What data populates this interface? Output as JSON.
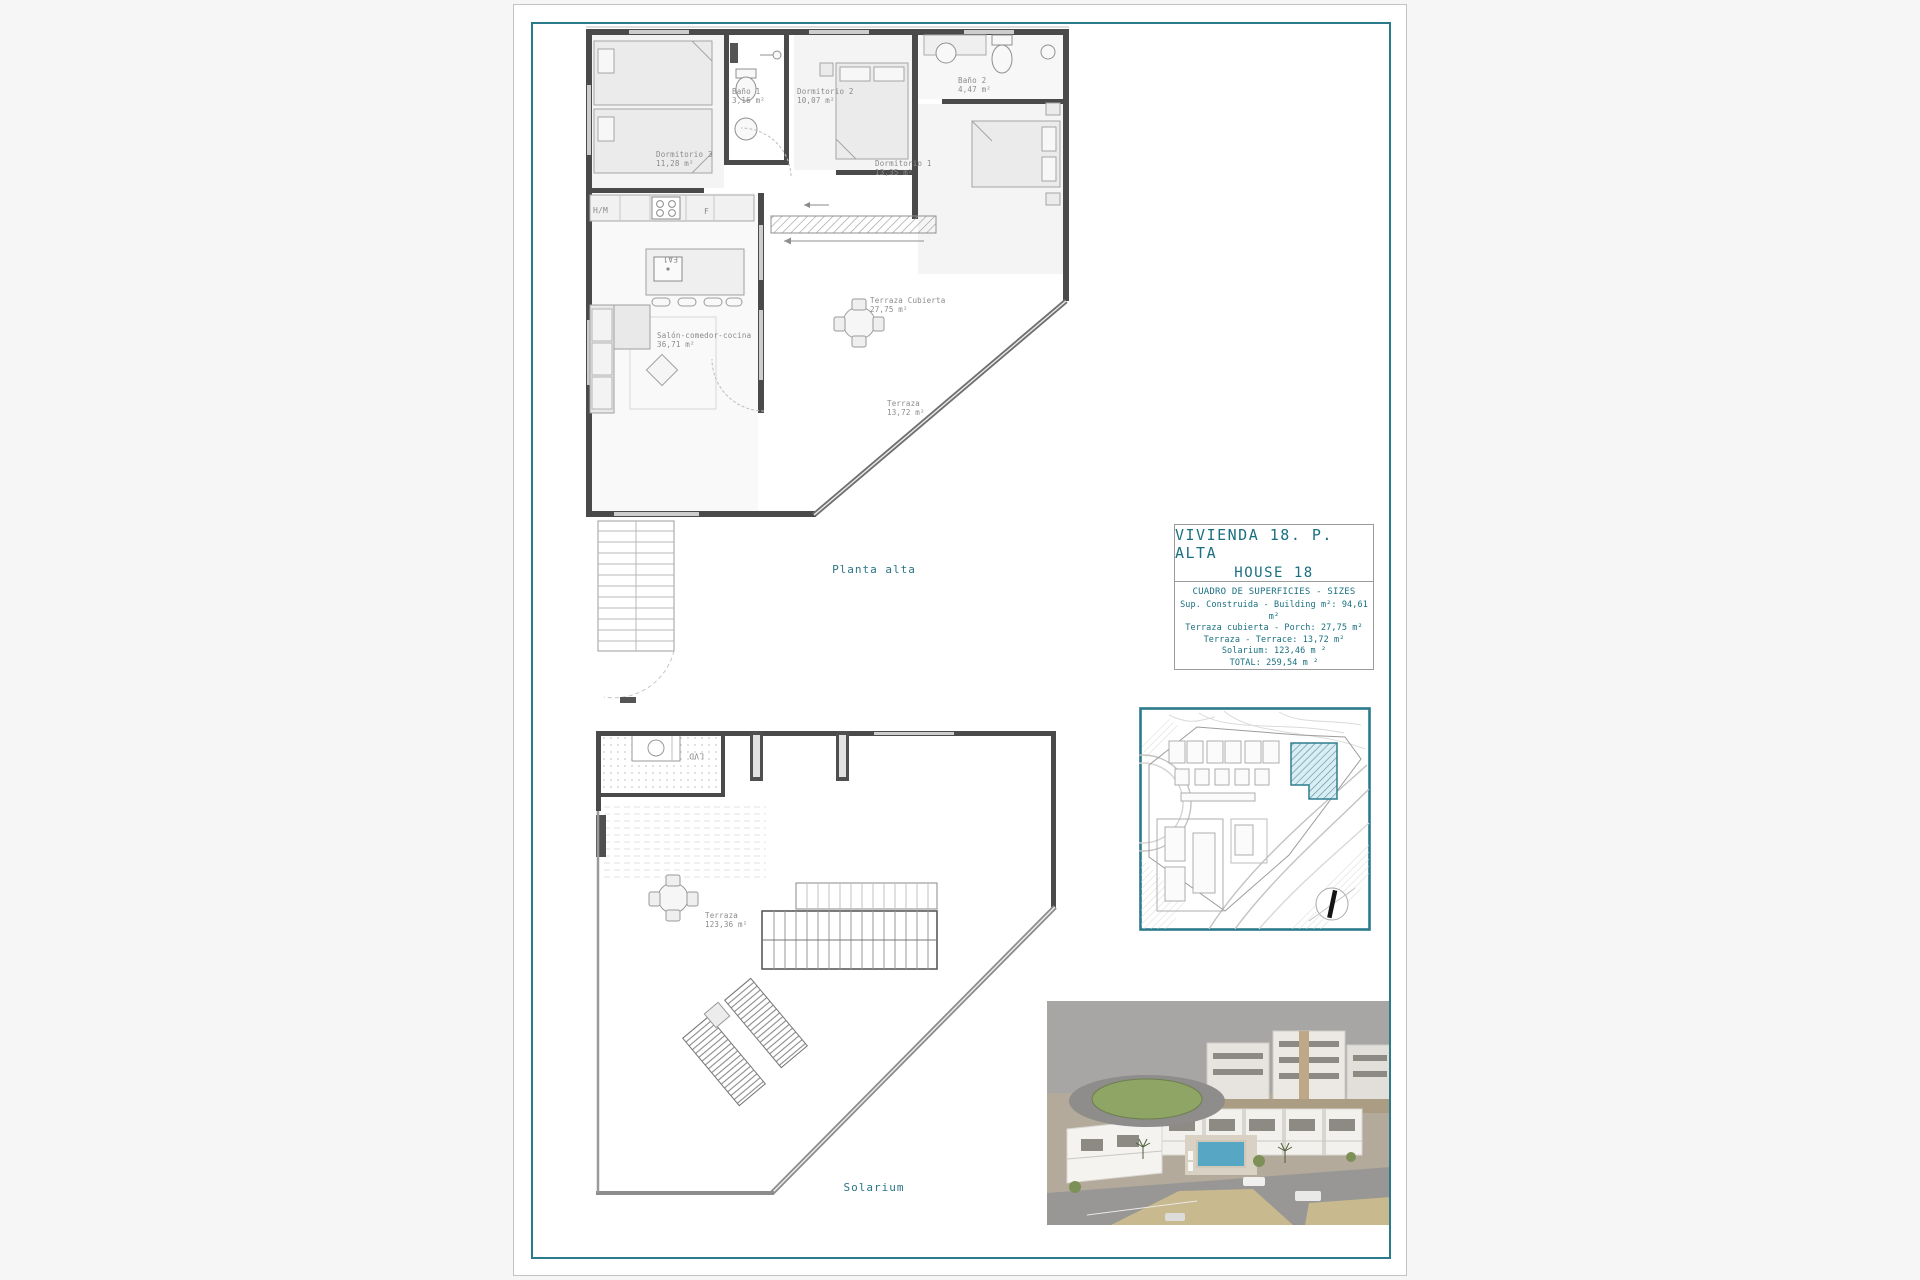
{
  "document": {
    "caption_upper": "Planta alta",
    "caption_lower": "Solarium"
  },
  "title_block": {
    "title_line1": "VIVIENDA 18. P. ALTA",
    "title_line2": "HOUSE 18",
    "table_title": "CUADRO DE SUPERFICIES  - SIZES",
    "rows": [
      "Sup. Construida - Building m²: 94,61 m²",
      "Terraza cubierta - Porch: 27,75 m²",
      "Terraza - Terrace: 13,72 m²",
      "Solarium:  123,46 m ²",
      "TOTAL:  259,54 m ²"
    ]
  },
  "upper_plan": {
    "rooms": {
      "dormitorio3": {
        "name": "Dormitorio 3",
        "area": "11,28 m²"
      },
      "bano1": {
        "name": "Baño 1",
        "area": "3,16 m²"
      },
      "dormitorio2": {
        "name": "Dormitorio 2",
        "area": "10,07 m²"
      },
      "bano2": {
        "name": "Baño 2",
        "area": "4,47 m²"
      },
      "dormitorio1": {
        "name": "Dormitorio 1",
        "area": "13,35 m²"
      },
      "salon": {
        "name": "Salón-comedor-cocina",
        "area": "36,71 m²"
      },
      "terraza_cubierta": {
        "name": "Terraza Cubierta",
        "area": "27,75 m²"
      },
      "terraza": {
        "name": "Terraza",
        "area": "13,72 m²"
      }
    },
    "appliance_labels": {
      "hm": "H/M",
      "f": "F",
      "island": "FA1"
    }
  },
  "solarium_plan": {
    "terraza": {
      "name": "Terraza",
      "area": "123,36 m²"
    },
    "laundry": "LVD"
  },
  "colors": {
    "frame_teal": "#2b7a8c",
    "title_text_teal": "#1a7080",
    "plan_label_gray": "#8a8a8a",
    "wall_gray": "#4a4a4a",
    "site_highlight_teal": "#4d8fa0"
  }
}
